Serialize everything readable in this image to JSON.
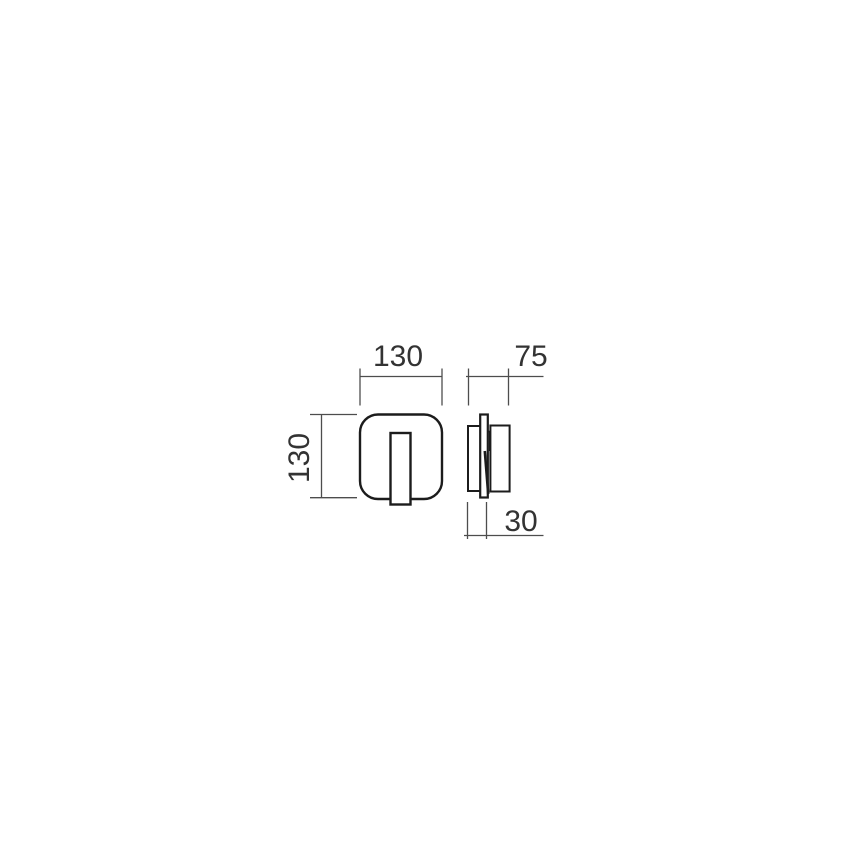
{
  "drawing": {
    "type": "technical-dimension-drawing",
    "subject": "wall light fixture, front view and side view",
    "background_color": "#ffffff",
    "colors": {
      "object_outline": "#1c1c1c",
      "dimension_line": "#4d4d4d",
      "label_text": "#333333"
    },
    "views": [
      {
        "id": "front-view",
        "description": "rounded square face plate with vertical rectangular insert extending slightly below"
      },
      {
        "id": "side-view",
        "description": "thin wall plate with body block behind and front block, tilted insert detail"
      }
    ],
    "dimensions": {
      "front_width": {
        "label": "130",
        "value": 130,
        "orientation": "horizontal",
        "position": "above front view"
      },
      "front_height": {
        "label": "130",
        "value": 130,
        "orientation": "vertical",
        "position": "left of front view"
      },
      "side_depth_total": {
        "label": "75",
        "value": 75,
        "orientation": "horizontal",
        "position": "above side view"
      },
      "side_depth_body": {
        "label": "30",
        "value": 30,
        "orientation": "horizontal",
        "position": "below side view"
      }
    }
  }
}
